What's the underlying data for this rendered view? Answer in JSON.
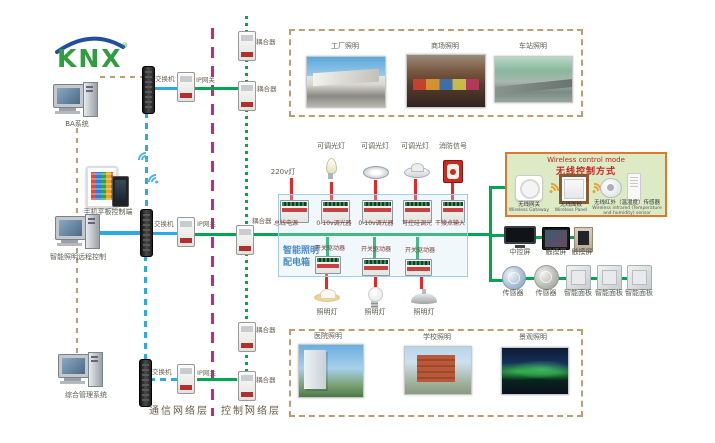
{
  "logo": {
    "text": "KNX"
  },
  "left_devices": {
    "pc1": "BA系统",
    "mobile": "手机平板控制端",
    "pc2": "智能照明远程控制",
    "pc3": "综合管理系统"
  },
  "comm": {
    "switches": [
      "交换机",
      "交换机",
      "交换机"
    ],
    "gateways": [
      "IP网关",
      "IP网关",
      "IP网关"
    ],
    "couplers": [
      "耦合器",
      "耦合器",
      "耦合器",
      "耦合器",
      "耦合器"
    ],
    "layer_comm": "通信网络层",
    "layer_ctrl": "控制网络层"
  },
  "top_photos": [
    "工厂照明",
    "商场照明",
    "车站照明"
  ],
  "bottom_photos": [
    "医院照明",
    "学校照明",
    "景观照明"
  ],
  "cabinet": {
    "title_line1": "智能照明",
    "title_line2": "配电箱",
    "feed_labels": [
      "220v灯",
      "可调光灯",
      "可调光灯",
      "可调光灯",
      "消防信号"
    ],
    "devices": [
      "总线电源",
      "0-10v调光器",
      "0-10v调光器",
      "可控硅调光",
      "干接点输入"
    ],
    "drivers": [
      "开关驱动器",
      "开关驱动器",
      "开关驱动器"
    ],
    "lamps": [
      "照明灯",
      "照明灯",
      "照明灯"
    ]
  },
  "wireless": {
    "title_en": "Wireless control mode",
    "title_zh": "无线控制方式",
    "items": [
      {
        "zh": "无线网关",
        "en": "Wireless Gateway"
      },
      {
        "zh": "无线面板",
        "en": "Wireless Panel"
      },
      {
        "zh": "无线红外（温湿度）传感器",
        "en": "Wireless infrared (Temperature and humidity) sensor"
      }
    ]
  },
  "right_devices": {
    "screens": [
      "中控屏",
      "触摸屏",
      "触摸屏"
    ],
    "sensors": [
      "传感器",
      "传感器"
    ],
    "panels": [
      "智能面板",
      "智能面板",
      "智能面板"
    ]
  },
  "colors": {
    "bus_green": "#00a651",
    "lan_blue": "#2aabe2",
    "power_red": "#ec2426",
    "layer_magenta": "#c2278f",
    "mgmt_tan": "#bd9e72"
  }
}
